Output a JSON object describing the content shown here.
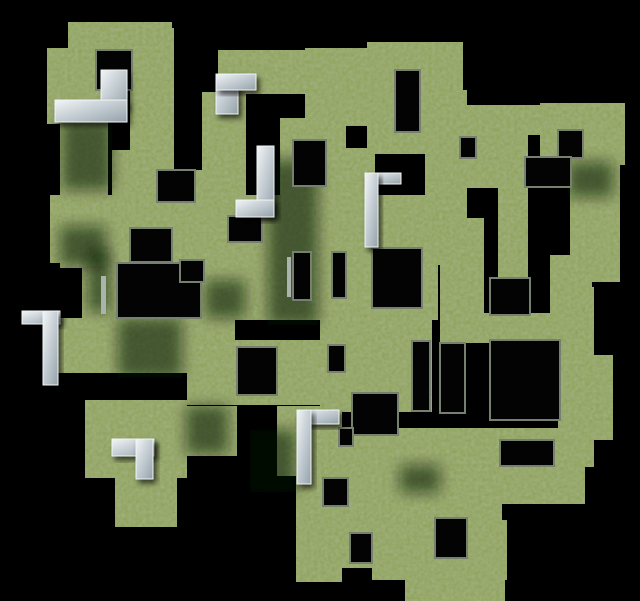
{
  "scene": {
    "label": "aerial render of a 3D maze with grass-covered walls on a black void",
    "width": 640,
    "height": 601
  },
  "palette": {
    "background": "#000000",
    "grass_base": "#8fa257",
    "grass_noise_dark": "#5d7038",
    "grass_shadowed": "#3f5231",
    "hole_fill": "#020302",
    "wall_rim": "#75816e",
    "stone_light": "#f2f5f6",
    "stone_mid": "#c3ccd2",
    "stone_dark": "#94a1aa",
    "sliver_gray": "#aab3ac",
    "shadow": "rgba(8,14,6,0.55)"
  },
  "maze": {
    "walls": [
      [
        68,
        22,
        104,
        28
      ],
      [
        130,
        28,
        44,
        145
      ],
      [
        47,
        48,
        56,
        76
      ],
      [
        60,
        118,
        48,
        150
      ],
      [
        112,
        150,
        62,
        115
      ],
      [
        50,
        195,
        185,
        68
      ],
      [
        195,
        170,
        40,
        95
      ],
      [
        82,
        255,
        26,
        65
      ],
      [
        50,
        318,
        185,
        55
      ],
      [
        203,
        263,
        32,
        60
      ],
      [
        218,
        50,
        94,
        44
      ],
      [
        202,
        92,
        44,
        125
      ],
      [
        235,
        195,
        210,
        70
      ],
      [
        305,
        48,
        92,
        78
      ],
      [
        367,
        42,
        96,
        112
      ],
      [
        280,
        118,
        66,
        112
      ],
      [
        340,
        148,
        35,
        75
      ],
      [
        425,
        90,
        42,
        130
      ],
      [
        108,
        250,
        330,
        70
      ],
      [
        463,
        105,
        80,
        30
      ],
      [
        540,
        103,
        85,
        62
      ],
      [
        570,
        157,
        50,
        125
      ],
      [
        440,
        128,
        88,
        60
      ],
      [
        498,
        157,
        30,
        160
      ],
      [
        440,
        218,
        44,
        102
      ],
      [
        550,
        255,
        42,
        70
      ],
      [
        440,
        313,
        130,
        30
      ],
      [
        558,
        287,
        36,
        180
      ],
      [
        585,
        355,
        28,
        85
      ],
      [
        320,
        300,
        112,
        112
      ],
      [
        187,
        340,
        138,
        65
      ],
      [
        85,
        400,
        102,
        78
      ],
      [
        115,
        472,
        62,
        55
      ],
      [
        187,
        406,
        50,
        50
      ],
      [
        277,
        406,
        48,
        70
      ],
      [
        296,
        410,
        46,
        172
      ],
      [
        330,
        428,
        130,
        26
      ],
      [
        330,
        448,
        140,
        120
      ],
      [
        372,
        520,
        135,
        60
      ],
      [
        405,
        555,
        100,
        46
      ],
      [
        460,
        428,
        42,
        173
      ],
      [
        497,
        428,
        88,
        76
      ]
    ],
    "holes": [
      [
        96,
        50,
        36,
        40
      ],
      [
        157,
        170,
        38,
        32
      ],
      [
        130,
        228,
        42,
        34
      ],
      [
        117,
        263,
        84,
        55
      ],
      [
        228,
        216,
        34,
        26
      ],
      [
        293,
        140,
        33,
        46
      ],
      [
        395,
        70,
        25,
        62
      ],
      [
        293,
        252,
        18,
        48
      ],
      [
        332,
        252,
        14,
        46
      ],
      [
        372,
        248,
        50,
        60
      ],
      [
        180,
        260,
        24,
        22
      ],
      [
        558,
        130,
        25,
        28
      ],
      [
        460,
        137,
        16,
        21
      ],
      [
        525,
        157,
        46,
        30
      ],
      [
        490,
        278,
        40,
        37
      ],
      [
        440,
        343,
        25,
        70
      ],
      [
        490,
        340,
        70,
        80
      ],
      [
        500,
        440,
        54,
        26
      ],
      [
        328,
        345,
        17,
        27
      ],
      [
        352,
        393,
        46,
        42
      ],
      [
        412,
        341,
        18,
        70
      ],
      [
        237,
        347,
        40,
        48
      ],
      [
        339,
        428,
        14,
        18
      ],
      [
        350,
        533,
        22,
        30
      ],
      [
        435,
        518,
        32,
        40
      ],
      [
        323,
        478,
        25,
        28
      ]
    ],
    "white_corners": [
      [
        101,
        70,
        26,
        38
      ],
      [
        55,
        100,
        72,
        22
      ],
      [
        216,
        74,
        22,
        40
      ],
      [
        216,
        74,
        40,
        16
      ],
      [
        257,
        146,
        17,
        68
      ],
      [
        236,
        200,
        38,
        17
      ],
      [
        365,
        173,
        36,
        11
      ],
      [
        365,
        173,
        13,
        74
      ],
      [
        22,
        311,
        38,
        13
      ],
      [
        43,
        311,
        15,
        74
      ],
      [
        112,
        439,
        42,
        17
      ],
      [
        136,
        439,
        17,
        40
      ],
      [
        297,
        410,
        42,
        14
      ],
      [
        297,
        410,
        14,
        74
      ]
    ],
    "gray_slivers": [
      [
        101,
        276,
        5,
        38
      ],
      [
        287,
        257,
        4,
        40
      ]
    ],
    "shadows": [
      [
        62,
        120,
        50,
        70
      ],
      [
        118,
        318,
        64,
        60
      ],
      [
        268,
        160,
        50,
        165
      ],
      [
        250,
        430,
        46,
        62
      ],
      [
        400,
        465,
        40,
        28
      ],
      [
        88,
        250,
        22,
        62
      ],
      [
        568,
        162,
        45,
        35
      ],
      [
        186,
        406,
        42,
        48
      ],
      [
        60,
        226,
        46,
        40
      ],
      [
        205,
        280,
        40,
        38
      ]
    ]
  }
}
